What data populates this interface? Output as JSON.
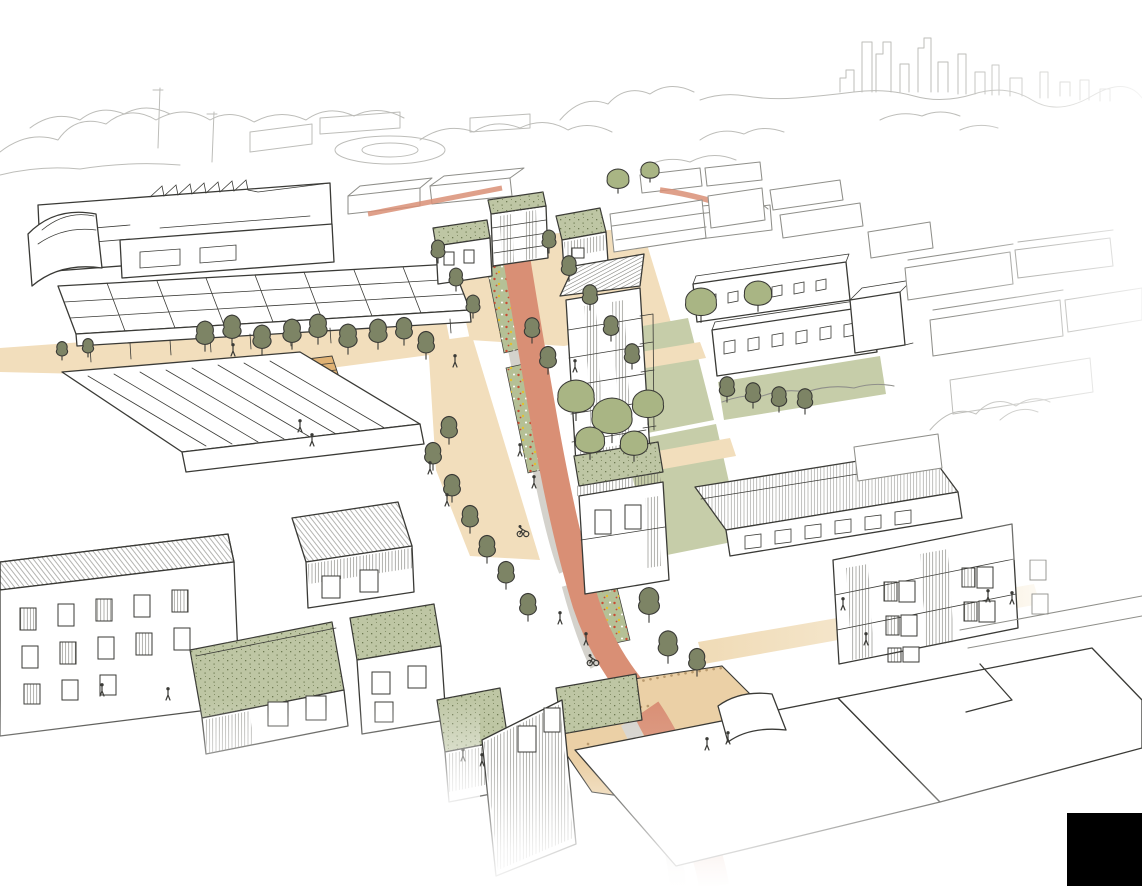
{
  "scene": {
    "kind": "hand-drawn architectural aerial sketch",
    "subject": "urban masterplan street with green roofs, street trees, rain gardens, terracotta cycle street, shared plazas and a distant city skyline",
    "width": 1142,
    "height": 886,
    "visible_text": []
  },
  "palette": {
    "paper": "#ffffff",
    "ink": "#3a3a36",
    "ink_medium": "#8f8f8a",
    "ink_light": "#bdbdb9",
    "road": "#d98f75",
    "road_faded": "#eccabb",
    "plaza": "#f2debc",
    "plaza_deep": "#ebd0a6",
    "plaza_dot": "#b99a6e",
    "deck": "#e0b274",
    "footway": "#d4d2cc",
    "rain_garden": "#b5c096",
    "lawn": "#c6cda9",
    "green_roof": "#bec6a4",
    "roof_speckle": "#6e7a52",
    "tree_dark": "#7d8465",
    "tree_light": "#a9b584",
    "flower_red": "#c84b33",
    "flower_yellow": "#e3c02f",
    "redaction": "#000000"
  },
  "trees": [
    [
      62,
      352,
      8,
      "d"
    ],
    [
      88,
      349,
      8,
      "d"
    ],
    [
      205,
      338,
      13,
      "d"
    ],
    [
      232,
      332,
      13,
      "d"
    ],
    [
      262,
      342,
      13,
      "d"
    ],
    [
      292,
      336,
      13,
      "d"
    ],
    [
      318,
      331,
      13,
      "d"
    ],
    [
      348,
      341,
      13,
      "d"
    ],
    [
      378,
      336,
      13,
      "d"
    ],
    [
      404,
      333,
      12,
      "d"
    ],
    [
      426,
      347,
      12,
      "d"
    ],
    [
      438,
      253,
      10,
      "d"
    ],
    [
      456,
      281,
      10,
      "d"
    ],
    [
      473,
      308,
      10,
      "d"
    ],
    [
      549,
      243,
      10,
      "d"
    ],
    [
      569,
      270,
      11,
      "d"
    ],
    [
      590,
      299,
      11,
      "d"
    ],
    [
      611,
      330,
      11,
      "d"
    ],
    [
      632,
      358,
      11,
      "d"
    ],
    [
      618,
      181,
      12,
      "l"
    ],
    [
      650,
      172,
      10,
      "l"
    ],
    [
      532,
      332,
      11,
      "d"
    ],
    [
      548,
      362,
      12,
      "d"
    ],
    [
      576,
      400,
      20,
      "l"
    ],
    [
      612,
      420,
      22,
      "l"
    ],
    [
      648,
      407,
      17,
      "l"
    ],
    [
      590,
      443,
      16,
      "l"
    ],
    [
      634,
      446,
      15,
      "l"
    ],
    [
      449,
      432,
      12,
      "d"
    ],
    [
      433,
      458,
      12,
      "d"
    ],
    [
      452,
      490,
      12,
      "d"
    ],
    [
      470,
      521,
      12,
      "d"
    ],
    [
      487,
      551,
      12,
      "d"
    ],
    [
      506,
      577,
      12,
      "d"
    ],
    [
      528,
      609,
      12,
      "d"
    ],
    [
      727,
      391,
      11,
      "d"
    ],
    [
      753,
      397,
      11,
      "d"
    ],
    [
      779,
      401,
      11,
      "d"
    ],
    [
      805,
      403,
      11,
      "d"
    ],
    [
      701,
      305,
      17,
      "l"
    ],
    [
      758,
      296,
      15,
      "l"
    ],
    [
      649,
      607,
      15,
      "d"
    ],
    [
      668,
      649,
      14,
      "d"
    ],
    [
      697,
      664,
      12,
      "d"
    ]
  ],
  "figures": [
    [
      233,
      352
    ],
    [
      455,
      363
    ],
    [
      575,
      368
    ],
    [
      300,
      428
    ],
    [
      312,
      442
    ],
    [
      430,
      470
    ],
    [
      447,
      502
    ],
    [
      520,
      452
    ],
    [
      534,
      484
    ],
    [
      560,
      620
    ],
    [
      586,
      641
    ],
    [
      843,
      606
    ],
    [
      866,
      641
    ],
    [
      988,
      598
    ],
    [
      1012,
      600
    ],
    [
      707,
      746
    ],
    [
      728,
      740
    ],
    [
      102,
      692
    ],
    [
      168,
      696
    ],
    [
      463,
      757
    ],
    [
      482,
      762
    ]
  ],
  "cyclists": [
    [
      523,
      534
    ],
    [
      593,
      663
    ]
  ],
  "redaction": {
    "x": 1067,
    "y": 813,
    "width": 75,
    "height": 73
  }
}
